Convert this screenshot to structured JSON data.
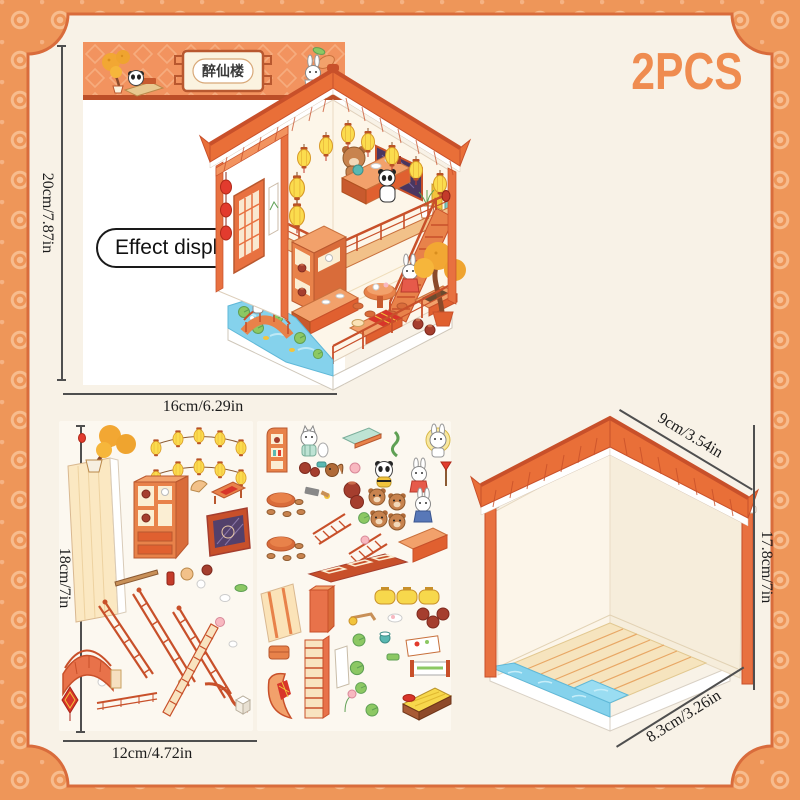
{
  "badge": {
    "label": "2PCS"
  },
  "card": {
    "banner_title": "醉仙楼",
    "effect_label": "Effect display",
    "height_label": "20cm/7.87in",
    "width_label": "16cm/6.29in"
  },
  "sheets": {
    "height_label": "18cm/7in",
    "width_label": "12cm/4.72in"
  },
  "room": {
    "roof_label": "9cm/3.54in",
    "height_label": "17.8cm/7in",
    "width_label": "8.3cm/3.26in"
  },
  "palette": {
    "background_orange": "#EE9659",
    "panel_cream": "#F8F2E7",
    "frame_line": "#D96C3C",
    "badge_text": "#EF8C50",
    "roof_orange": "#E96F38",
    "wood_orange": "#E8824A",
    "dark_trim": "#C8502A",
    "lantern_yellow": "#FBDC4E",
    "water_blue": "#85D2EC",
    "window_purple": "#53406B",
    "dimension_text": "#1C1C1C"
  }
}
